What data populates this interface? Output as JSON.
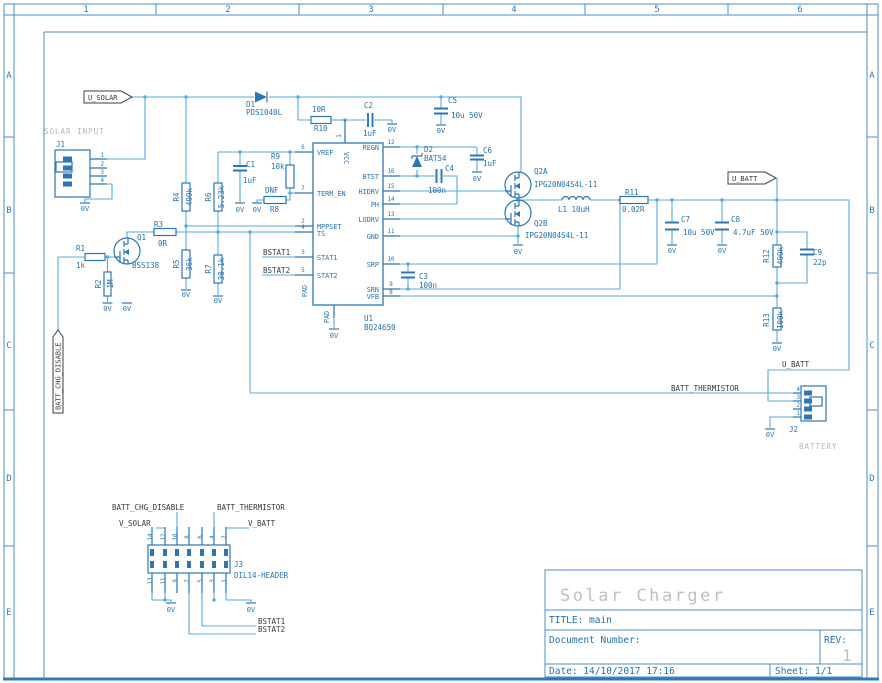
{
  "frame": {
    "cols": [
      {
        "t": "1",
        "x": 86
      },
      {
        "t": "2",
        "x": 228
      },
      {
        "t": "3",
        "x": 371
      },
      {
        "t": "4",
        "x": 514
      },
      {
        "t": "5",
        "x": 657
      },
      {
        "t": "6",
        "x": 800
      }
    ],
    "rows": [
      {
        "t": "A",
        "y": 78
      },
      {
        "t": "B",
        "y": 213
      },
      {
        "t": "C",
        "y": 348
      },
      {
        "t": "D",
        "y": 481
      },
      {
        "t": "E",
        "y": 615
      }
    ]
  },
  "title_block": {
    "project": "Solar Charger",
    "title_label": "TITLE:",
    "title": "main",
    "doc_label": "Document Number:",
    "rev_label": "REV:",
    "rev": "1",
    "date": "Date: 14/10/2017 17:16",
    "sheet": "Sheet: 1/1"
  },
  "texts": [
    {
      "n": "flag-u-solar",
      "t": "U_SOLAR",
      "x": 88,
      "y": 100,
      "c": "flag"
    },
    {
      "n": "flag-u-batt",
      "t": "U_BATT",
      "x": 732,
      "y": 181,
      "c": "flag"
    },
    {
      "n": "flag-batt-chg-disable",
      "t": "BATT_CHG_DISABLE",
      "x": 60.5,
      "y": 410,
      "c": "flag",
      "r": -90
    },
    {
      "n": "label-solar-input",
      "t": "SOLAR INPUT",
      "x": 44,
      "y": 134,
      "c": "gray"
    },
    {
      "n": "label-battery",
      "t": "BATTERY",
      "x": 799,
      "y": 449,
      "c": "gray"
    },
    {
      "n": "net-bstat1",
      "t": "BSTAT1",
      "x": 263,
      "y": 255,
      "c": "net"
    },
    {
      "n": "net-bstat2",
      "t": "BSTAT2",
      "x": 263,
      "y": 273,
      "c": "net"
    },
    {
      "n": "net-batt-thermistor",
      "t": "BATT_THERMISTOR",
      "x": 671,
      "y": 391,
      "c": "net"
    },
    {
      "n": "net-u-batt",
      "t": "U_BATT",
      "x": 782,
      "y": 367,
      "c": "net"
    },
    {
      "n": "net-v-solar",
      "t": "V_SOLAR",
      "x": 119,
      "y": 526,
      "c": "net"
    },
    {
      "n": "net-v-batt",
      "t": "V_BATT",
      "x": 248,
      "y": 526,
      "c": "net"
    },
    {
      "n": "net-batt-chg-disable",
      "t": "BATT_CHG_DISABLE",
      "x": 112,
      "y": 510,
      "c": "net"
    },
    {
      "n": "net-batt-thermistor-2",
      "t": "BATT_THERMISTOR",
      "x": 217,
      "y": 510,
      "c": "net"
    },
    {
      "n": "net-bstat1-2",
      "t": "BSTAT1",
      "x": 258,
      "y": 624,
      "c": "net"
    },
    {
      "n": "net-bstat2-2",
      "t": "BSTAT2",
      "x": 258,
      "y": 632,
      "c": "net"
    },
    {
      "n": "pwr-0v-j1",
      "t": "0V",
      "x": 85,
      "y": 211,
      "c": "pwr"
    },
    {
      "n": "pwr-0v-r2",
      "t": "0V",
      "x": 107.5,
      "y": 311,
      "c": "pwr"
    },
    {
      "n": "pwr-0v-q1",
      "t": "0V",
      "x": 127,
      "y": 311,
      "c": "pwr"
    },
    {
      "n": "pwr-0v-c1",
      "t": "0V",
      "x": 240,
      "y": 212,
      "c": "pwr"
    },
    {
      "n": "pwr-0v-r8",
      "t": "0V",
      "x": 257,
      "y": 212,
      "c": "pwr"
    },
    {
      "n": "pwr-0v-r5",
      "t": "0V",
      "x": 186,
      "y": 297,
      "c": "pwr"
    },
    {
      "n": "pwr-0v-r7",
      "t": "0V",
      "x": 218,
      "y": 303,
      "c": "pwr"
    },
    {
      "n": "pwr-0v-pad",
      "t": "0V",
      "x": 334,
      "y": 338,
      "c": "pwr"
    },
    {
      "n": "pwr-0v-c2",
      "t": "0V",
      "x": 392,
      "y": 132,
      "c": "pwr"
    },
    {
      "n": "pwr-0v-c5",
      "t": "0V",
      "x": 441,
      "y": 133,
      "c": "pwr"
    },
    {
      "n": "pwr-0v-c6",
      "t": "0V",
      "x": 477,
      "y": 181,
      "c": "pwr"
    },
    {
      "n": "pwr-0v-q2b",
      "t": "0V",
      "x": 518,
      "y": 254,
      "c": "pwr"
    },
    {
      "n": "pwr-0v-c7",
      "t": "0V",
      "x": 672,
      "y": 253,
      "c": "pwr"
    },
    {
      "n": "pwr-0v-c8",
      "t": "0V",
      "x": 722,
      "y": 253,
      "c": "pwr"
    },
    {
      "n": "pwr-0v-r13",
      "t": "0V",
      "x": 777,
      "y": 351,
      "c": "pwr"
    },
    {
      "n": "pwr-0v-j2",
      "t": "0V",
      "x": 770,
      "y": 437,
      "c": "pwr"
    },
    {
      "n": "pwr-0v-j3a",
      "t": "0V",
      "x": 171,
      "y": 612,
      "c": "pwr"
    },
    {
      "n": "pwr-0v-j3b",
      "t": "0V",
      "x": 251,
      "y": 612,
      "c": "pwr"
    },
    {
      "n": "ref-j1",
      "t": "J1",
      "x": 56,
      "y": 147,
      "c": "ref"
    },
    {
      "n": "ref-r1",
      "t": "R1",
      "x": 76,
      "y": 251,
      "c": "ref"
    },
    {
      "n": "val-r1",
      "t": "1k",
      "x": 76,
      "y": 268,
      "c": "ref"
    },
    {
      "n": "ref-r2",
      "t": "R2",
      "x": 101,
      "y": 284,
      "c": "ref",
      "r": -90,
      "a": "middle"
    },
    {
      "n": "val-r2",
      "t": "1M",
      "x": 113,
      "y": 284,
      "c": "ref",
      "r": -90,
      "a": "middle"
    },
    {
      "n": "ref-q1",
      "t": "Q1",
      "x": 137,
      "y": 240,
      "c": "ref"
    },
    {
      "n": "val-q1",
      "t": "BSS138",
      "x": 132,
      "y": 268,
      "c": "ref"
    },
    {
      "n": "ref-r3",
      "t": "R3",
      "x": 154,
      "y": 227,
      "c": "ref"
    },
    {
      "n": "val-r3",
      "t": "0R",
      "x": 158,
      "y": 246,
      "c": "ref"
    },
    {
      "n": "ref-r4",
      "t": "R4",
      "x": 179,
      "y": 197,
      "c": "ref",
      "r": -90,
      "a": "middle"
    },
    {
      "n": "val-r4",
      "t": "499k",
      "x": 192,
      "y": 197,
      "c": "ref",
      "r": -90,
      "a": "middle"
    },
    {
      "n": "ref-r5",
      "t": "R5",
      "x": 179,
      "y": 264,
      "c": "ref",
      "r": -90,
      "a": "middle"
    },
    {
      "n": "val-r5",
      "t": "36k",
      "x": 192,
      "y": 264,
      "c": "ref",
      "r": -90,
      "a": "middle"
    },
    {
      "n": "ref-r6",
      "t": "R6",
      "x": 211,
      "y": 197,
      "c": "ref",
      "r": -90,
      "a": "middle"
    },
    {
      "n": "val-r6",
      "t": "5.23k",
      "x": 224,
      "y": 197,
      "c": "ref",
      "r": -90,
      "a": "middle"
    },
    {
      "n": "ref-r7",
      "t": "R7",
      "x": 211,
      "y": 269,
      "c": "ref",
      "r": -90,
      "a": "middle"
    },
    {
      "n": "val-r7",
      "t": "30.1k",
      "x": 224,
      "y": 269,
      "c": "ref",
      "r": -90,
      "a": "middle"
    },
    {
      "n": "ref-c1",
      "t": "C1",
      "x": 246,
      "y": 167,
      "c": "ref"
    },
    {
      "n": "val-c1",
      "t": "1uF",
      "x": 243,
      "y": 183,
      "c": "ref"
    },
    {
      "n": "ref-r9",
      "t": "R9",
      "x": 271,
      "y": 159,
      "c": "ref"
    },
    {
      "n": "val-r9",
      "t": "10k",
      "x": 271,
      "y": 169,
      "c": "ref"
    },
    {
      "n": "val-r8",
      "t": "DNF",
      "x": 265,
      "y": 193,
      "c": "ref"
    },
    {
      "n": "ref-r8",
      "t": "R8",
      "x": 270,
      "y": 212,
      "c": "ref"
    },
    {
      "n": "ref-d1",
      "t": "D1",
      "x": 246,
      "y": 107,
      "c": "ref"
    },
    {
      "n": "val-d1",
      "t": "PDS1040L",
      "x": 246,
      "y": 115,
      "c": "ref"
    },
    {
      "n": "val-r10",
      "t": "10R",
      "x": 312,
      "y": 112,
      "c": "ref"
    },
    {
      "n": "ref-r10",
      "t": "R10",
      "x": 314,
      "y": 131,
      "c": "ref"
    },
    {
      "n": "ref-c2",
      "t": "C2",
      "x": 364,
      "y": 108,
      "c": "ref"
    },
    {
      "n": "val-c2",
      "t": "1uF",
      "x": 363,
      "y": 136,
      "c": "ref"
    },
    {
      "n": "ref-c5",
      "t": "C5",
      "x": 448,
      "y": 103,
      "c": "ref"
    },
    {
      "n": "val-c5",
      "t": "10u 50V",
      "x": 451,
      "y": 118,
      "c": "ref"
    },
    {
      "n": "ref-d2",
      "t": "D2",
      "x": 424,
      "y": 152,
      "c": "ref"
    },
    {
      "n": "val-d2",
      "t": "BAT54",
      "x": 424,
      "y": 161,
      "c": "ref"
    },
    {
      "n": "ref-c4",
      "t": "C4",
      "x": 445,
      "y": 171,
      "c": "ref"
    },
    {
      "n": "val-c4",
      "t": "100n",
      "x": 428,
      "y": 193,
      "c": "ref"
    },
    {
      "n": "ref-c6",
      "t": "C6",
      "x": 483,
      "y": 153,
      "c": "ref"
    },
    {
      "n": "val-c6",
      "t": "1uF",
      "x": 483,
      "y": 166,
      "c": "ref"
    },
    {
      "n": "ref-q2a",
      "t": "Q2A",
      "x": 534,
      "y": 174,
      "c": "ref"
    },
    {
      "n": "val-q2a",
      "t": "IPG20N04S4L-11",
      "x": 534,
      "y": 187,
      "c": "ref"
    },
    {
      "n": "ref-q2b",
      "t": "Q2B",
      "x": 534,
      "y": 226,
      "c": "ref"
    },
    {
      "n": "val-q2b",
      "t": "IPG20N04S4L-11",
      "x": 525,
      "y": 238,
      "c": "ref"
    },
    {
      "n": "ref-l1",
      "t": "L1 10uH",
      "x": 558,
      "y": 212,
      "c": "ref"
    },
    {
      "n": "ref-r11",
      "t": "R11",
      "x": 625,
      "y": 195,
      "c": "ref"
    },
    {
      "n": "val-r11",
      "t": "0.02R",
      "x": 622,
      "y": 212,
      "c": "ref"
    },
    {
      "n": "ref-c3",
      "t": "C3",
      "x": 419,
      "y": 279,
      "c": "ref"
    },
    {
      "n": "val-c3",
      "t": "100n",
      "x": 419,
      "y": 288,
      "c": "ref"
    },
    {
      "n": "ref-c7",
      "t": "C7",
      "x": 681,
      "y": 222,
      "c": "ref"
    },
    {
      "n": "val-c7",
      "t": "10u 50V",
      "x": 683,
      "y": 235,
      "c": "ref"
    },
    {
      "n": "ref-c8",
      "t": "C8",
      "x": 731,
      "y": 222,
      "c": "ref"
    },
    {
      "n": "val-c8",
      "t": "4.7uF 50V",
      "x": 733,
      "y": 235,
      "c": "ref"
    },
    {
      "n": "ref-r12",
      "t": "R12",
      "x": 769,
      "y": 256,
      "c": "ref",
      "r": -90,
      "a": "middle"
    },
    {
      "n": "val-r12",
      "t": "499k",
      "x": 783,
      "y": 256,
      "c": "ref",
      "r": -90,
      "a": "middle"
    },
    {
      "n": "ref-c9",
      "t": "C9",
      "x": 813,
      "y": 255,
      "c": "ref"
    },
    {
      "n": "val-c9",
      "t": "22p",
      "x": 813,
      "y": 265,
      "c": "ref"
    },
    {
      "n": "ref-r13",
      "t": "R13",
      "x": 769,
      "y": 320,
      "c": "ref",
      "r": -90,
      "a": "middle"
    },
    {
      "n": "val-r13",
      "t": "100k",
      "x": 783,
      "y": 320,
      "c": "ref",
      "r": -90,
      "a": "middle"
    },
    {
      "n": "ref-u1",
      "t": "U1",
      "x": 364,
      "y": 321,
      "c": "ref"
    },
    {
      "n": "val-u1",
      "t": "BQ24650",
      "x": 364,
      "y": 330,
      "c": "ref"
    },
    {
      "n": "ref-j2",
      "t": "J2",
      "x": 789,
      "y": 432,
      "c": "ref"
    },
    {
      "n": "ref-j3",
      "t": "J3",
      "x": 234,
      "y": 567,
      "c": "ref"
    },
    {
      "n": "val-j3",
      "t": "DIL14-HEADER",
      "x": 234,
      "y": 578,
      "c": "ref"
    },
    {
      "n": "ic-pin-vref",
      "t": "VREF",
      "x": 317,
      "y": 155,
      "c": "pname"
    },
    {
      "n": "ic-pin-term-en",
      "t": "TERM_EN",
      "x": 317,
      "y": 196,
      "c": "pname"
    },
    {
      "n": "ic-pin-mppset",
      "t": "MPPSET",
      "x": 317,
      "y": 229,
      "c": "pname"
    },
    {
      "n": "ic-pin-ts",
      "t": "TS",
      "x": 317,
      "y": 236,
      "c": "pname"
    },
    {
      "n": "ic-pin-stat1",
      "t": "STAT1",
      "x": 317,
      "y": 260,
      "c": "pname"
    },
    {
      "n": "ic-pin-stat2",
      "t": "STAT2",
      "x": 317,
      "y": 278,
      "c": "pname"
    },
    {
      "n": "ic-pin-vcc",
      "t": "VCC",
      "x": 344,
      "y": 152,
      "c": "pname",
      "r": 90
    },
    {
      "n": "ic-pin-pad",
      "t": "PAD",
      "x": 307,
      "y": 291,
      "c": "pname",
      "r": -90,
      "a": "middle"
    },
    {
      "n": "ic-pin-pad2",
      "t": "PAD",
      "x": 329,
      "y": 317,
      "c": "pname",
      "r": -90,
      "a": "middle"
    },
    {
      "n": "ic-pin-regn",
      "t": "REGN",
      "x": 379,
      "y": 150,
      "c": "pname",
      "a": "end"
    },
    {
      "n": "ic-pin-btst",
      "t": "BTST",
      "x": 379,
      "y": 179,
      "c": "pname",
      "a": "end"
    },
    {
      "n": "ic-pin-hidrv",
      "t": "HIDRV",
      "x": 379,
      "y": 194,
      "c": "pname",
      "a": "end"
    },
    {
      "n": "ic-pin-ph",
      "t": "PH",
      "x": 379,
      "y": 207,
      "c": "pname",
      "a": "end"
    },
    {
      "n": "ic-pin-lodrv",
      "t": "LODRV",
      "x": 379,
      "y": 222,
      "c": "pname",
      "a": "end"
    },
    {
      "n": "ic-pin-gnd",
      "t": "GND",
      "x": 379,
      "y": 239,
      "c": "pname",
      "a": "end"
    },
    {
      "n": "ic-pin-srp",
      "t": "SRP",
      "x": 379,
      "y": 267,
      "c": "pname",
      "a": "end"
    },
    {
      "n": "ic-pin-srn",
      "t": "SRN",
      "x": 379,
      "y": 292,
      "c": "pname",
      "a": "end"
    },
    {
      "n": "ic-pin-vfb",
      "t": "VFB",
      "x": 379,
      "y": 299,
      "c": "pname",
      "a": "end"
    },
    {
      "n": "pinnum-6",
      "t": "6",
      "x": 303,
      "y": 149,
      "c": "pin",
      "a": "middle"
    },
    {
      "n": "pinnum-7",
      "t": "7",
      "x": 303,
      "y": 190,
      "c": "pin",
      "a": "middle"
    },
    {
      "n": "pinnum-2",
      "t": "2",
      "x": 303,
      "y": 223,
      "c": "pin",
      "a": "middle"
    },
    {
      "n": "pinnum-4",
      "t": "4",
      "x": 303,
      "y": 229,
      "c": "pin",
      "a": "middle"
    },
    {
      "n": "pinnum-3",
      "t": "3",
      "x": 303,
      "y": 254,
      "c": "pin",
      "a": "middle"
    },
    {
      "n": "pinnum-5",
      "t": "5",
      "x": 303,
      "y": 272,
      "c": "pin",
      "a": "middle"
    },
    {
      "n": "pinnum-12",
      "t": "12",
      "x": 391,
      "y": 144,
      "c": "pin",
      "a": "middle"
    },
    {
      "n": "pinnum-16",
      "t": "16",
      "x": 391,
      "y": 173,
      "c": "pin",
      "a": "middle"
    },
    {
      "n": "pinnum-15",
      "t": "15",
      "x": 391,
      "y": 188,
      "c": "pin",
      "a": "middle"
    },
    {
      "n": "pinnum-14",
      "t": "14",
      "x": 391,
      "y": 201,
      "c": "pin",
      "a": "middle"
    },
    {
      "n": "pinnum-13",
      "t": "13",
      "x": 391,
      "y": 216,
      "c": "pin",
      "a": "middle"
    },
    {
      "n": "pinnum-11",
      "t": "11",
      "x": 391,
      "y": 233,
      "c": "pin",
      "a": "middle"
    },
    {
      "n": "pinnum-10",
      "t": "10",
      "x": 391,
      "y": 261,
      "c": "pin",
      "a": "middle"
    },
    {
      "n": "pinnum-9",
      "t": "9",
      "x": 391,
      "y": 286,
      "c": "pin",
      "a": "middle"
    },
    {
      "n": "pinnum-8",
      "t": "8",
      "x": 391,
      "y": 294,
      "c": "pin",
      "a": "middle"
    },
    {
      "n": "pinnum-vcc1",
      "t": "1",
      "x": 341,
      "y": 136,
      "c": "pin",
      "r": -90,
      "a": "middle"
    },
    {
      "n": "j1-pin-1",
      "t": "1",
      "x": 104,
      "y": 157,
      "c": "pin",
      "a": "end"
    },
    {
      "n": "j1-pin-2",
      "t": "2",
      "x": 104,
      "y": 166,
      "c": "pin",
      "a": "end"
    },
    {
      "n": "j1-pin-3",
      "t": "3",
      "x": 104,
      "y": 174,
      "c": "pin",
      "a": "end"
    },
    {
      "n": "j1-pin-4",
      "t": "4",
      "x": 104,
      "y": 182,
      "c": "pin",
      "a": "end"
    },
    {
      "n": "j2-pin-4",
      "t": "4",
      "x": 800,
      "y": 391,
      "c": "pin",
      "a": "end"
    },
    {
      "n": "j2-pin-3",
      "t": "3",
      "x": 800,
      "y": 399,
      "c": "pin",
      "a": "end"
    },
    {
      "n": "j2-pin-2",
      "t": "2",
      "x": 800,
      "y": 407,
      "c": "pin",
      "a": "end"
    },
    {
      "n": "j2-pin-1",
      "t": "1",
      "x": 800,
      "y": 415,
      "c": "pin",
      "a": "end"
    },
    {
      "n": "j3-pin-14",
      "t": "14",
      "x": 152,
      "y": 537,
      "c": "pin",
      "r": -90,
      "a": "middle"
    },
    {
      "n": "j3-pin-12",
      "t": "12",
      "x": 165,
      "y": 537,
      "c": "pin",
      "r": -90,
      "a": "middle"
    },
    {
      "n": "j3-pin-10",
      "t": "10",
      "x": 177,
      "y": 537,
      "c": "pin",
      "r": -90,
      "a": "middle"
    },
    {
      "n": "j3-pin-8",
      "t": "8",
      "x": 189,
      "y": 537,
      "c": "pin",
      "r": -90,
      "a": "middle"
    },
    {
      "n": "j3-pin-6",
      "t": "6",
      "x": 202,
      "y": 537,
      "c": "pin",
      "r": -90,
      "a": "middle"
    },
    {
      "n": "j3-pin-4",
      "t": "4",
      "x": 214,
      "y": 537,
      "c": "pin",
      "r": -90,
      "a": "middle"
    },
    {
      "n": "j3-pin-2",
      "t": "2",
      "x": 226,
      "y": 537,
      "c": "pin",
      "r": -90,
      "a": "middle"
    },
    {
      "n": "j3-pin-13",
      "t": "13",
      "x": 152,
      "y": 581,
      "c": "pin",
      "r": -90,
      "a": "middle"
    },
    {
      "n": "j3-pin-11",
      "t": "11",
      "x": 165,
      "y": 581,
      "c": "pin",
      "r": -90,
      "a": "middle"
    },
    {
      "n": "j3-pin-9",
      "t": "9",
      "x": 177,
      "y": 581,
      "c": "pin",
      "r": -90,
      "a": "middle"
    },
    {
      "n": "j3-pin-7",
      "t": "7",
      "x": 189,
      "y": 581,
      "c": "pin",
      "r": -90,
      "a": "middle"
    },
    {
      "n": "j3-pin-5",
      "t": "5",
      "x": 202,
      "y": 581,
      "c": "pin",
      "r": -90,
      "a": "middle"
    },
    {
      "n": "j3-pin-3",
      "t": "3",
      "x": 214,
      "y": 581,
      "c": "pin",
      "r": -90,
      "a": "middle"
    },
    {
      "n": "j3-pin-1",
      "t": "1",
      "x": 226,
      "y": 581,
      "c": "pin",
      "r": -90,
      "a": "middle"
    }
  ]
}
